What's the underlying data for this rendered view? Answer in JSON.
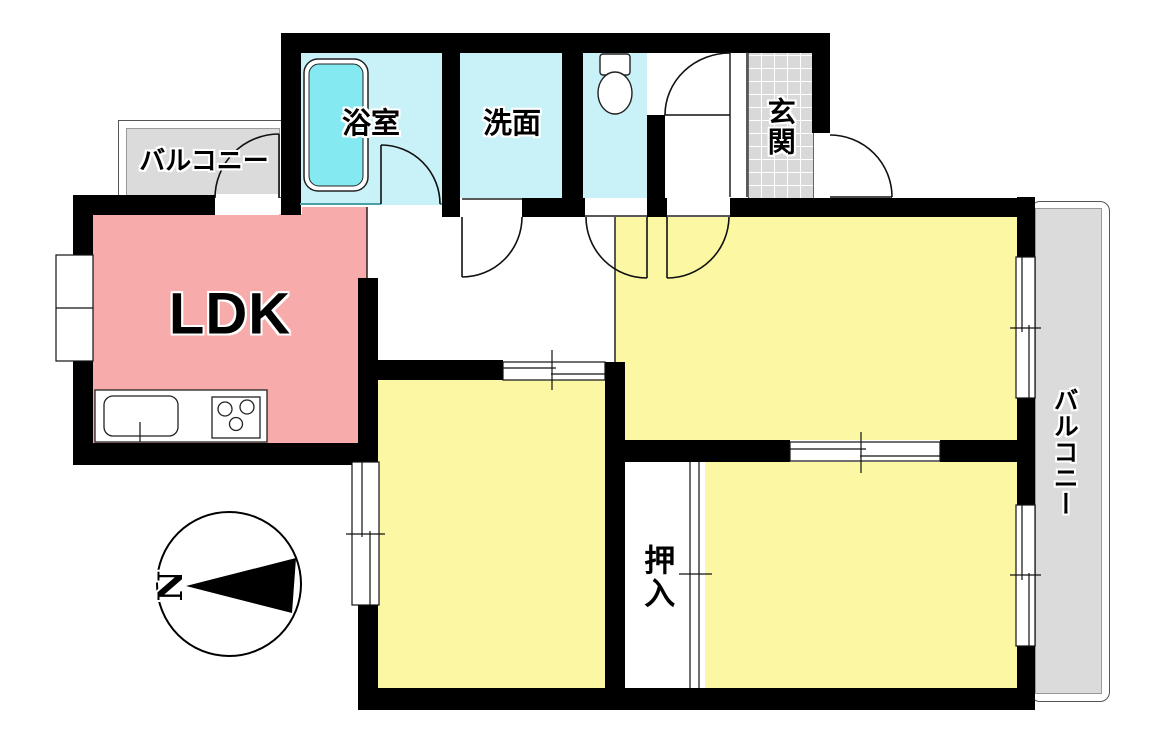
{
  "plan": {
    "type": "floor-plan",
    "rooms": {
      "ldk": {
        "label": "LDK"
      },
      "bathroom": {
        "label": "浴室"
      },
      "washroom": {
        "label": "洗面"
      },
      "entrance": {
        "label": "玄関"
      },
      "closet": {
        "label": "押入"
      },
      "balcony_top": {
        "label": "バルコニー"
      },
      "balcony_right": {
        "label": "バルコニー"
      }
    },
    "compass": {
      "label": "N",
      "direction": "north-left"
    },
    "fixtures": [
      "bathtub",
      "toilet",
      "kitchen-sink",
      "kitchen-stove"
    ],
    "colors": {
      "wall": "#000000",
      "ldk": "#F8ABAB",
      "bed": "#FBF7A2",
      "wet": "#C9F2F8",
      "tub": "#84E9F0",
      "balc": "#DBDBDB",
      "genkan": "#D9D9D9",
      "line": "#111111"
    }
  }
}
